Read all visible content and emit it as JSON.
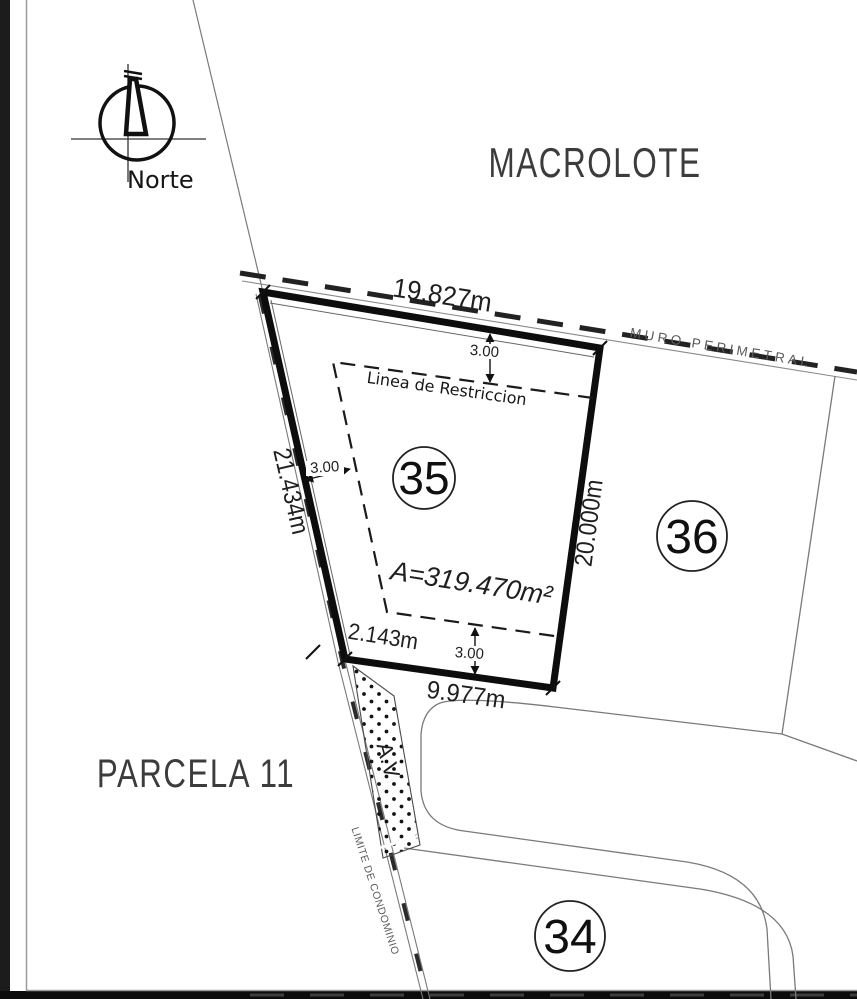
{
  "plan": {
    "north_label": "Norte",
    "zones": {
      "macrolote": "MACROLOTE",
      "parcela": "PARCELA 11"
    },
    "lot35": {
      "number": "35",
      "area_label": "A=319.470m²",
      "dim_top": "19.827m",
      "dim_left": "21.434m",
      "dim_right": "20.000m",
      "dim_bottom": "9.977m",
      "dim_corner": "2.143m",
      "setback_top": "3.00",
      "setback_left": "3.00",
      "setback_bottom": "3.00",
      "restriction_label": "Linea de Restriccion"
    },
    "lot36_number": "36",
    "lot34_number": "34",
    "labels": {
      "muro_perimetral": "MURO PERIMETRAL",
      "limite_condominio": "LIMITE DE CONDOMINIO",
      "area_verde": "A.V"
    },
    "colors": {
      "ink": "#1a1a1a",
      "thin_line": "#7a7a7a",
      "muted_text": "#5a5a5a",
      "paper": "#ffffff"
    }
  }
}
